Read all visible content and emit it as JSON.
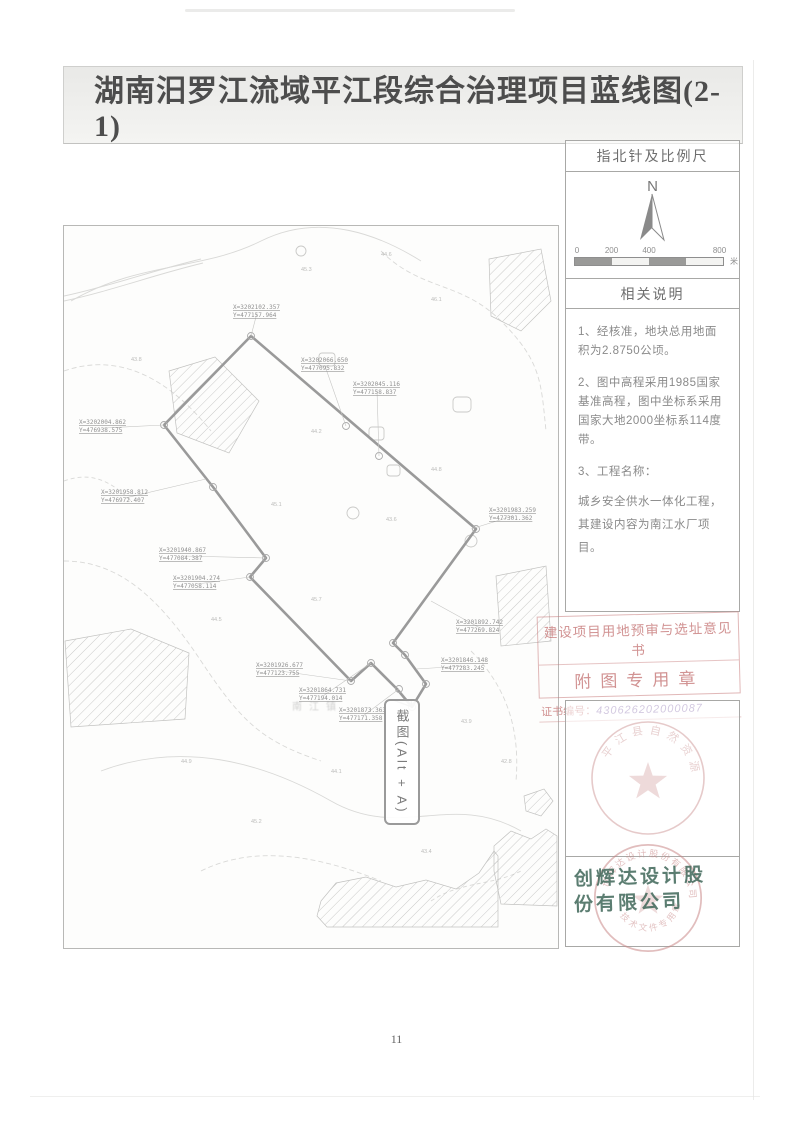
{
  "title": "湖南汨罗江流域平江段综合治理项目蓝线图(2-1)",
  "page": {
    "number": "11"
  },
  "sidebar": {
    "compass_header": "指北针及比例尺",
    "north_label": "N",
    "scale": {
      "ticks": [
        "0",
        "200",
        "400",
        "800"
      ],
      "unit": "米"
    },
    "notes_header": "相关说明",
    "notes": [
      "1、经核准，地块总用地面积为2.8750公顷。",
      "2、图中高程采用1985国家基准高程，图中坐标系采用国家大地2000坐标系114度带。",
      "3、工程名称：",
      "城乡安全供水一体化工程，其建设内容为南江水厂项目。"
    ],
    "approval_stamp": {
      "line1": "建设项目用地预审与选址意见书",
      "line2": "附图专用章",
      "cert_label": "证书编号：",
      "cert_number": "430626202000087"
    },
    "gov_seal": {
      "arc_text": "平江县自然资源局"
    },
    "company_stamp": {
      "name_line1": "创辉达设计股",
      "name_line2": "份有限公司",
      "arc_text": "创辉达设计股份有限公司",
      "sub_text": "技术文件专用章"
    }
  },
  "map": {
    "screenshot_button": "截图(Alt + A)",
    "area_label": "南江镇",
    "coordinate_labels": [
      {
        "x": 232,
        "y": 303,
        "X": "X=3202102.357",
        "Y": "Y=477157.964",
        "lx": 250,
        "ly": 335
      },
      {
        "x": 300,
        "y": 356,
        "X": "X=3202066.650",
        "Y": "Y=477095.832",
        "lx": 345,
        "ly": 425
      },
      {
        "x": 352,
        "y": 380,
        "X": "X=3202045.116",
        "Y": "Y=477158.837",
        "lx": 378,
        "ly": 455
      },
      {
        "x": 78,
        "y": 418,
        "X": "X=3202004.862",
        "Y": "Y=476938.575",
        "lx": 163,
        "ly": 424
      },
      {
        "x": 100,
        "y": 488,
        "X": "X=3201958.812",
        "Y": "Y=476972.407",
        "lx": 205,
        "ly": 478
      },
      {
        "x": 158,
        "y": 546,
        "X": "X=3201940.867",
        "Y": "Y=477084.387",
        "lx": 265,
        "ly": 557
      },
      {
        "x": 172,
        "y": 574,
        "X": "X=3201904.274",
        "Y": "Y=477058.114",
        "lx": 249,
        "ly": 576
      },
      {
        "x": 255,
        "y": 661,
        "X": "X=3201926.677",
        "Y": "Y=477123.755",
        "lx": 350,
        "ly": 680
      },
      {
        "x": 298,
        "y": 686,
        "X": "X=3201864.731",
        "Y": "Y=477194.014",
        "lx": 370,
        "ly": 662
      },
      {
        "x": 338,
        "y": 706,
        "X": "X=3201873.363",
        "Y": "Y=477171.358",
        "lx": 398,
        "ly": 688
      },
      {
        "x": 455,
        "y": 618,
        "X": "X=3201892.742",
        "Y": "Y=477269.824",
        "lx": 430,
        "ly": 600
      },
      {
        "x": 440,
        "y": 656,
        "X": "X=3201846.148",
        "Y": "Y=477283.245",
        "lx": 415,
        "ly": 668
      },
      {
        "x": 488,
        "y": 506,
        "X": "X=3201983.259",
        "Y": "Y=477301.362",
        "lx": 470,
        "ly": 528
      }
    ],
    "spot_elevations": [
      {
        "x": 300,
        "y": 270,
        "v": "45.3"
      },
      {
        "x": 380,
        "y": 255,
        "v": "44.6"
      },
      {
        "x": 430,
        "y": 300,
        "v": "46.1"
      },
      {
        "x": 130,
        "y": 360,
        "v": "43.8"
      },
      {
        "x": 310,
        "y": 432,
        "v": "44.2"
      },
      {
        "x": 270,
        "y": 505,
        "v": "45.1"
      },
      {
        "x": 385,
        "y": 520,
        "v": "43.6"
      },
      {
        "x": 430,
        "y": 470,
        "v": "44.8"
      },
      {
        "x": 210,
        "y": 620,
        "v": "44.5"
      },
      {
        "x": 310,
        "y": 600,
        "v": "45.7"
      },
      {
        "x": 460,
        "y": 722,
        "v": "43.9"
      },
      {
        "x": 330,
        "y": 772,
        "v": "44.1"
      },
      {
        "x": 250,
        "y": 822,
        "v": "45.2"
      },
      {
        "x": 420,
        "y": 852,
        "v": "43.4"
      },
      {
        "x": 180,
        "y": 762,
        "v": "44.9"
      },
      {
        "x": 500,
        "y": 762,
        "v": "42.8"
      }
    ]
  },
  "colors": {
    "boundary_gray": "#9a9a9a",
    "stamp_red": "#c98b8b",
    "company_teal": "#3e6658",
    "label_gray": "#909090"
  }
}
